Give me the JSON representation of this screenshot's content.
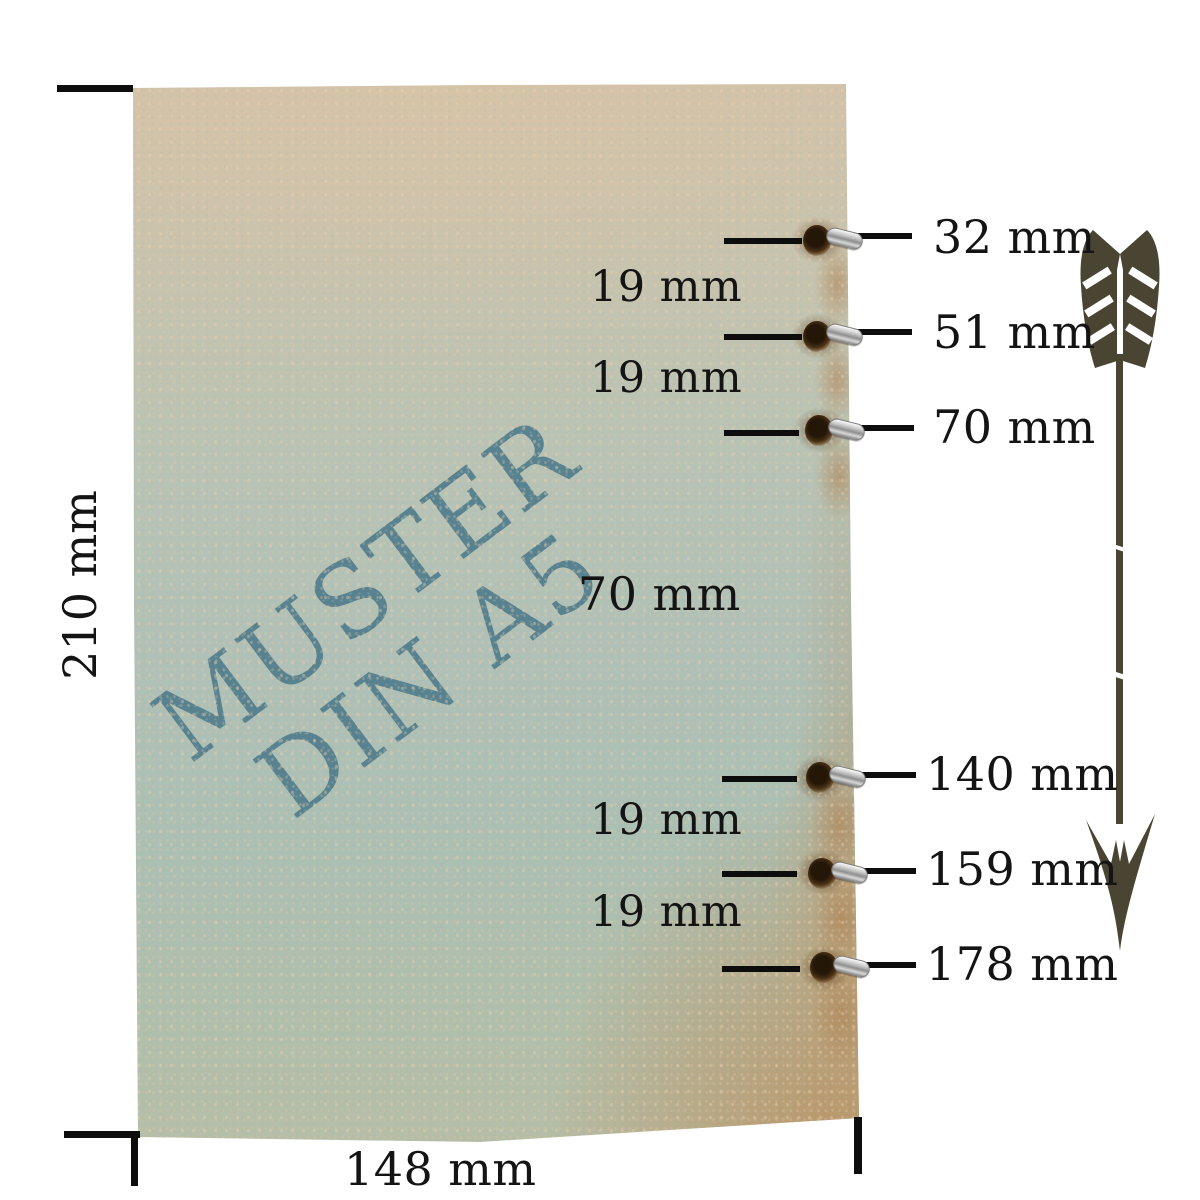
{
  "diagram": {
    "watermark": {
      "line1": "MUSTER",
      "line2": "DIN A5"
    },
    "page_height_label": "210 mm",
    "page_width_label": "148 mm",
    "holes": [
      {
        "position_mm": 32,
        "label": "32 mm"
      },
      {
        "position_mm": 51,
        "label": "51 mm"
      },
      {
        "position_mm": 70,
        "label": "70 mm"
      },
      {
        "position_mm": 140,
        "label": "140 mm"
      },
      {
        "position_mm": 159,
        "label": "159 mm"
      },
      {
        "position_mm": 178,
        "label": "178 mm"
      }
    ],
    "gaps": [
      {
        "gap_mm": 19,
        "label": "19 mm"
      },
      {
        "gap_mm": 19,
        "label": "19 mm"
      },
      {
        "gap_mm": 70,
        "label": "70 mm"
      },
      {
        "gap_mm": 19,
        "label": "19 mm"
      },
      {
        "gap_mm": 19,
        "label": "19 mm"
      }
    ],
    "colors": {
      "watermark": "#58828f",
      "paper_teal": "#aec0b6",
      "paper_beige": "#d2c2a9",
      "paper_tan": "#ba9466",
      "line": "#0d0d0d",
      "arrow": "#4a4433",
      "eyelet_silver": "#c7c7c7",
      "stain_brown": "#8a6137"
    }
  }
}
